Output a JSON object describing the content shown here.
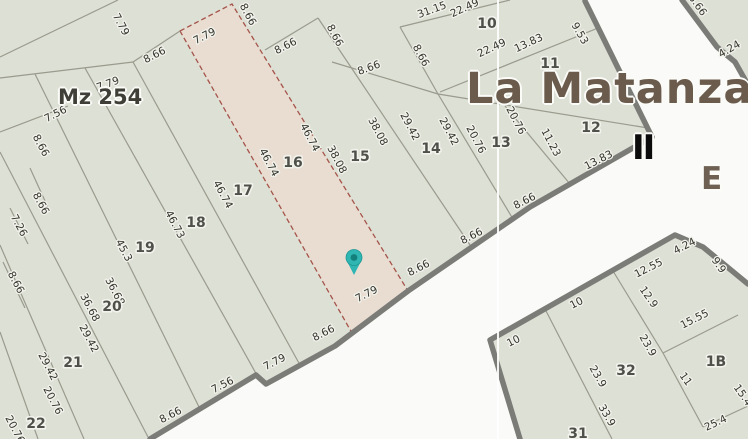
{
  "map": {
    "title": "La Matanza",
    "block_label": "Mz 254",
    "street_label_ii": "II",
    "zone_label_e": "E",
    "selected_lot": "16",
    "colors": {
      "background": "#f9f9f6",
      "road": "#fafaf8",
      "block_fill": "#dde0d5",
      "selected_fill": "#e9ddd2",
      "selected_stroke": "#a5544a",
      "thin_line": "#9a9a8e",
      "thick_line": "#7b7b77",
      "seam": "#ffffff",
      "dim_text": "#35352d",
      "lot_text": "#50504a",
      "title_text": "#6a5b4c",
      "marker": "#2fb6b3",
      "marker_dot": "#14807c"
    },
    "seam_x": 498,
    "marker": {
      "x": 354,
      "y": 262
    },
    "blocks": [
      {
        "name": "block-mz254",
        "points": [
          [
            0,
            0
          ],
          [
            585,
            0
          ],
          [
            652,
            137
          ],
          [
            530,
            207
          ],
          [
            408,
            291
          ],
          [
            335,
            346
          ],
          [
            266,
            384
          ],
          [
            256,
            375
          ],
          [
            150,
            439
          ],
          [
            0,
            439
          ]
        ]
      },
      {
        "name": "block-lower-right",
        "points": [
          [
            520,
            439
          ],
          [
            490,
            340
          ],
          [
            675,
            235
          ],
          [
            703,
            247
          ],
          [
            748,
            284
          ],
          [
            748,
            439
          ]
        ]
      },
      {
        "name": "block-top-right",
        "points": [
          [
            682,
            0
          ],
          [
            748,
            0
          ],
          [
            748,
            85
          ],
          [
            735,
            62
          ],
          [
            717,
            47
          ]
        ]
      }
    ],
    "thick_edges": [
      [
        [
          585,
          1
        ],
        [
          652,
          137
        ]
      ],
      [
        [
          652,
          137
        ],
        [
          530,
          207
        ],
        [
          408,
          291
        ],
        [
          335,
          346
        ],
        [
          266,
          384
        ],
        [
          256,
          375
        ],
        [
          150,
          439
        ]
      ],
      [
        [
          520,
          439
        ],
        [
          490,
          340
        ],
        [
          675,
          235
        ],
        [
          703,
          247
        ],
        [
          748,
          284
        ]
      ],
      [
        [
          682,
          0
        ],
        [
          717,
          47
        ],
        [
          735,
          62
        ],
        [
          748,
          85
        ]
      ]
    ],
    "thin_lines": [
      [
        [
          0,
          57
        ],
        [
          118,
          0
        ]
      ],
      [
        [
          0,
          78
        ],
        [
          133,
          62
        ],
        [
          180,
          31
        ]
      ],
      [
        [
          133,
          62
        ],
        [
          300,
          365
        ]
      ],
      [
        [
          85,
          68
        ],
        [
          258,
          377
        ]
      ],
      [
        [
          35,
          74
        ],
        [
          200,
          409
        ]
      ],
      [
        [
          0,
          152
        ],
        [
          148,
          437
        ]
      ],
      [
        [
          0,
          245
        ],
        [
          84,
          439
        ]
      ],
      [
        [
          0,
          332
        ],
        [
          38,
          439
        ]
      ],
      [
        [
          0,
          132
        ],
        [
          68,
          106
        ]
      ],
      [
        [
          10,
          208
        ],
        [
          28,
          244
        ]
      ],
      [
        [
          30,
          168
        ],
        [
          50,
          212
        ]
      ],
      [
        [
          3,
          262
        ],
        [
          25,
          308
        ]
      ],
      [
        [
          265,
          50
        ],
        [
          318,
          18
        ]
      ],
      [
        [
          318,
          18
        ],
        [
          470,
          245
        ]
      ],
      [
        [
          332,
          62
        ],
        [
          438,
          94
        ]
      ],
      [
        [
          438,
          94
        ],
        [
          648,
          128
        ]
      ],
      [
        [
          400,
          27
        ],
        [
          438,
          94
        ]
      ],
      [
        [
          400,
          27
        ],
        [
          510,
          0
        ]
      ],
      [
        [
          440,
          92
        ],
        [
          598,
          28
        ]
      ],
      [
        [
          438,
          94
        ],
        [
          513,
          219
        ]
      ],
      [
        [
          505,
          106
        ],
        [
          570,
          184
        ]
      ],
      [
        [
          545,
          309
        ],
        [
          612,
          439
        ]
      ],
      [
        [
          613,
          271
        ],
        [
          663,
          353
        ]
      ],
      [
        [
          663,
          353
        ],
        [
          703,
          427
        ]
      ],
      [
        [
          663,
          353
        ],
        [
          738,
          315
        ]
      ],
      [
        [
          703,
          427
        ],
        [
          748,
          406
        ]
      ]
    ],
    "selected_parcel_points": [
      [
        180,
        31
      ],
      [
        232,
        4
      ],
      [
        408,
        291
      ],
      [
        352,
        333
      ]
    ],
    "lot_labels": [
      {
        "t": "10",
        "x": 487,
        "y": 23
      },
      {
        "t": "11",
        "x": 550,
        "y": 63
      },
      {
        "t": "12",
        "x": 591,
        "y": 127
      },
      {
        "t": "13",
        "x": 501,
        "y": 142
      },
      {
        "t": "14",
        "x": 431,
        "y": 148
      },
      {
        "t": "15",
        "x": 360,
        "y": 156
      },
      {
        "t": "16",
        "x": 293,
        "y": 162
      },
      {
        "t": "17",
        "x": 243,
        "y": 190
      },
      {
        "t": "18",
        "x": 196,
        "y": 222
      },
      {
        "t": "19",
        "x": 145,
        "y": 247
      },
      {
        "t": "20",
        "x": 112,
        "y": 306
      },
      {
        "t": "21",
        "x": 73,
        "y": 362
      },
      {
        "t": "22",
        "x": 36,
        "y": 423
      },
      {
        "t": "31",
        "x": 578,
        "y": 433
      },
      {
        "t": "32",
        "x": 626,
        "y": 370
      },
      {
        "t": "1B",
        "x": 716,
        "y": 361
      }
    ],
    "dim_labels": [
      {
        "t": "7.79",
        "x": 118,
        "y": 26,
        "r": 62
      },
      {
        "t": "8.66",
        "x": 156,
        "y": 58,
        "r": -27
      },
      {
        "t": "7.79",
        "x": 109,
        "y": 87,
        "r": -20
      },
      {
        "t": "7.56",
        "x": 57,
        "y": 117,
        "r": -27
      },
      {
        "t": "8.66",
        "x": 38,
        "y": 147,
        "r": 62
      },
      {
        "t": "8.66",
        "x": 38,
        "y": 205,
        "r": 62
      },
      {
        "t": "7.26",
        "x": 16,
        "y": 227,
        "r": 62
      },
      {
        "t": "8.66",
        "x": 13,
        "y": 284,
        "r": 62
      },
      {
        "t": "7.79",
        "x": 206,
        "y": 39,
        "r": -27
      },
      {
        "t": "8.66",
        "x": 245,
        "y": 16,
        "r": 62
      },
      {
        "t": "8.66",
        "x": 287,
        "y": 49,
        "r": -27
      },
      {
        "t": "8.66",
        "x": 332,
        "y": 37,
        "r": 62
      },
      {
        "t": "8.66",
        "x": 370,
        "y": 71,
        "r": -20
      },
      {
        "t": "8.66",
        "x": 418,
        "y": 57,
        "r": 62
      },
      {
        "t": "46.74",
        "x": 307,
        "y": 139,
        "r": 62
      },
      {
        "t": "46.74",
        "x": 266,
        "y": 164,
        "r": 62
      },
      {
        "t": "38.08",
        "x": 375,
        "y": 133,
        "r": 62
      },
      {
        "t": "38.08",
        "x": 334,
        "y": 161,
        "r": 62
      },
      {
        "t": "46.74",
        "x": 220,
        "y": 196,
        "r": 62
      },
      {
        "t": "46.73",
        "x": 172,
        "y": 226,
        "r": 62
      },
      {
        "t": "45.3",
        "x": 121,
        "y": 252,
        "r": 62
      },
      {
        "t": "36.68",
        "x": 112,
        "y": 293,
        "r": 62
      },
      {
        "t": "36.68",
        "x": 87,
        "y": 309,
        "r": 62
      },
      {
        "t": "29.42",
        "x": 86,
        "y": 340,
        "r": 62
      },
      {
        "t": "29.42",
        "x": 45,
        "y": 368,
        "r": 62
      },
      {
        "t": "20.76",
        "x": 50,
        "y": 402,
        "r": 62
      },
      {
        "t": "20.76",
        "x": 12,
        "y": 431,
        "r": 62
      },
      {
        "t": "31.15",
        "x": 433,
        "y": 13,
        "r": -20
      },
      {
        "t": "22.49",
        "x": 466,
        "y": 11,
        "r": -25
      },
      {
        "t": "22.49",
        "x": 493,
        "y": 51,
        "r": -25
      },
      {
        "t": "13.83",
        "x": 530,
        "y": 46,
        "r": -25
      },
      {
        "t": "9.53",
        "x": 577,
        "y": 35,
        "r": 60
      },
      {
        "t": "29.42",
        "x": 407,
        "y": 128,
        "r": 62
      },
      {
        "t": "29.42",
        "x": 446,
        "y": 133,
        "r": 62
      },
      {
        "t": "20.76",
        "x": 513,
        "y": 122,
        "r": 62
      },
      {
        "t": "20.76",
        "x": 473,
        "y": 141,
        "r": 62
      },
      {
        "t": "11.23",
        "x": 548,
        "y": 144,
        "r": 62
      },
      {
        "t": "13.83",
        "x": 600,
        "y": 163,
        "r": -27
      },
      {
        "t": "8.66",
        "x": 526,
        "y": 204,
        "r": -27
      },
      {
        "t": "8.66",
        "x": 473,
        "y": 239,
        "r": -27
      },
      {
        "t": "8.66",
        "x": 420,
        "y": 271,
        "r": -27
      },
      {
        "t": "7.79",
        "x": 368,
        "y": 297,
        "r": -27
      },
      {
        "t": "8.66",
        "x": 325,
        "y": 336,
        "r": -27
      },
      {
        "t": "7.79",
        "x": 276,
        "y": 365,
        "r": -27
      },
      {
        "t": "7.56",
        "x": 224,
        "y": 388,
        "r": -27
      },
      {
        "t": "8.66",
        "x": 172,
        "y": 418,
        "r": -27
      },
      {
        "t": "10",
        "x": 578,
        "y": 306,
        "r": -27
      },
      {
        "t": "10",
        "x": 515,
        "y": 344,
        "r": -27
      },
      {
        "t": "12.55",
        "x": 650,
        "y": 271,
        "r": -27
      },
      {
        "t": "4.24",
        "x": 686,
        "y": 249,
        "r": -27
      },
      {
        "t": "9.9",
        "x": 716,
        "y": 267,
        "r": 55
      },
      {
        "t": "12.9",
        "x": 646,
        "y": 299,
        "r": 55
      },
      {
        "t": "23.9",
        "x": 645,
        "y": 347,
        "r": 60
      },
      {
        "t": "23.9",
        "x": 595,
        "y": 378,
        "r": 60
      },
      {
        "t": "33.9",
        "x": 604,
        "y": 417,
        "r": 60
      },
      {
        "t": "15.55",
        "x": 696,
        "y": 322,
        "r": -27
      },
      {
        "t": "11",
        "x": 683,
        "y": 381,
        "r": 55
      },
      {
        "t": "25.4",
        "x": 717,
        "y": 426,
        "r": -25
      },
      {
        "t": "15.4",
        "x": 740,
        "y": 397,
        "r": 55
      },
      {
        "t": "8.66",
        "x": 695,
        "y": 7,
        "r": 55
      },
      {
        "t": "4.24",
        "x": 731,
        "y": 52,
        "r": -30
      }
    ]
  }
}
